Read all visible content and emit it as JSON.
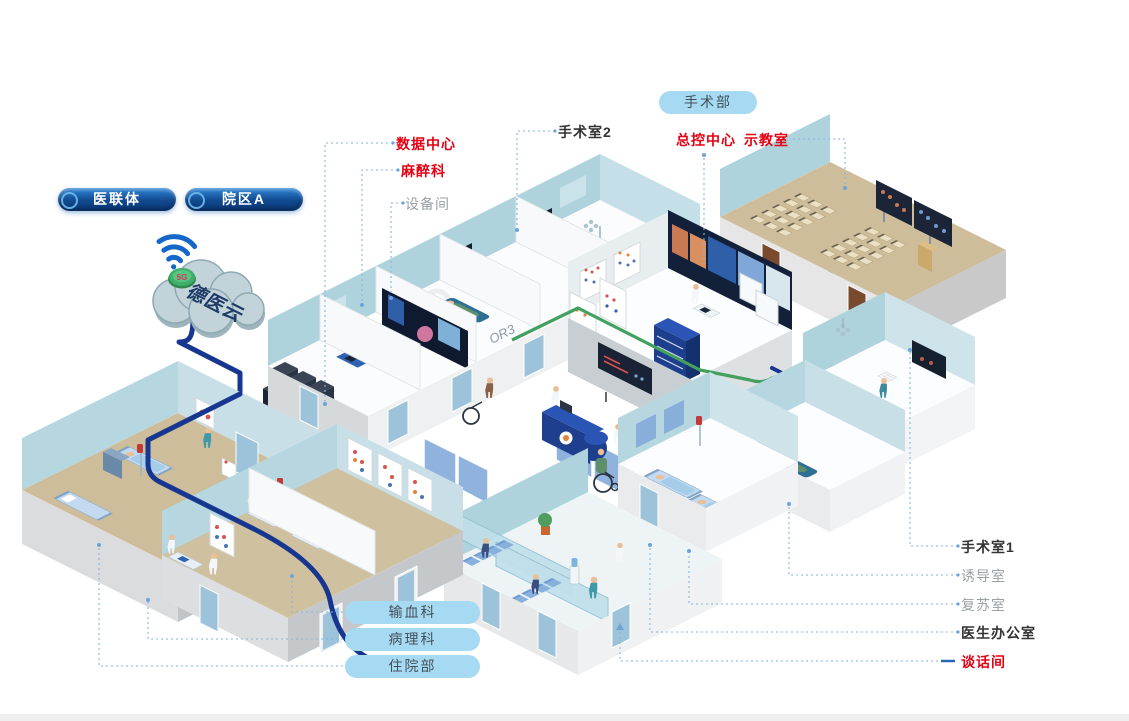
{
  "page": {
    "background": "#ffffff"
  },
  "cloud": {
    "name": "德医云",
    "badge": "5G"
  },
  "org_pills": [
    {
      "label": "医联体"
    },
    {
      "label": "院区A"
    }
  ],
  "department_pill": {
    "label": "手术部"
  },
  "callouts": {
    "data_center": {
      "label": "数据中心",
      "style": "red"
    },
    "anesthesiology": {
      "label": "麻醉科",
      "style": "red"
    },
    "equipment_room": {
      "label": "设备间",
      "style": "gray"
    },
    "operating_room_2": {
      "label": "手术室2",
      "style": "dark"
    },
    "master_control": {
      "label": "总控中心",
      "style": "red"
    },
    "demo_classroom": {
      "label": "示教室",
      "style": "red"
    },
    "operating_room_1": {
      "label": "手术室1",
      "style": "dark"
    },
    "induction_room": {
      "label": "诱导室",
      "style": "gray"
    },
    "recovery_room": {
      "label": "复苏室",
      "style": "gray"
    },
    "doctor_office": {
      "label": "医生办公室",
      "style": "dark"
    },
    "talk_room": {
      "label": "谈话间",
      "style": "red"
    }
  },
  "bottom_pills": [
    {
      "label": "输血科"
    },
    {
      "label": "病理科"
    },
    {
      "label": "住院部"
    }
  ],
  "room_tags": {
    "or2": "OR2",
    "or3": "OR3"
  },
  "colors": {
    "label_red": "#e60013",
    "label_dark": "#333333",
    "label_gray": "#9aa0a6",
    "navy_cable": "#16368f",
    "green_cable": "#43a05e",
    "leader_line": "#85b5e0",
    "pill_light_bg": "#a6d9f2",
    "pill_dark_top": "#2f86d6",
    "pill_dark_bottom": "#0b3a7c",
    "wall_blue": "#aed3dc",
    "floor_tan": "#cdbd9b",
    "cloud_fill": "#c2d4da",
    "badge_green": "#3fae68"
  }
}
